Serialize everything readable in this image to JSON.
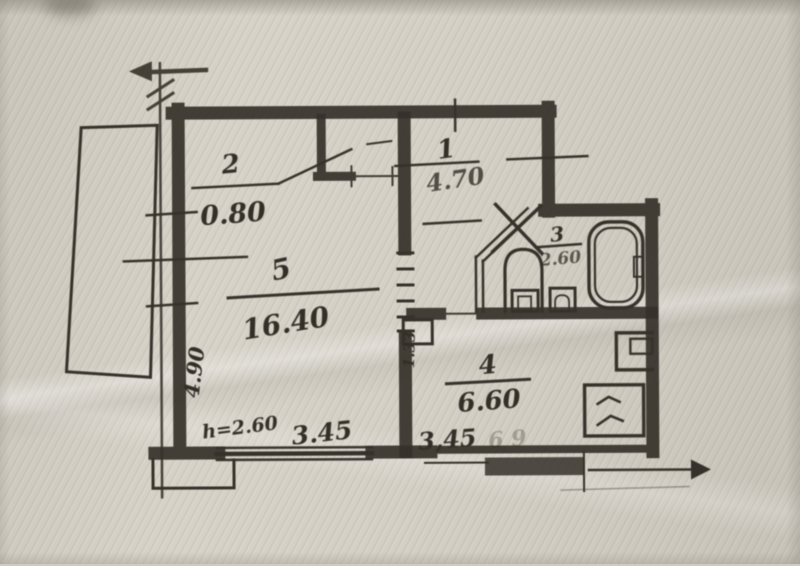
{
  "document": {
    "kind": "scanned apartment floor plan (BTI drawing)",
    "paper_color": "#d3cfc5",
    "ink_color": "#36312a",
    "rooms": [
      {
        "number": "1",
        "area": "4.70"
      },
      {
        "number": "2",
        "area": "0.80"
      },
      {
        "number": "3",
        "area": "2.60"
      },
      {
        "number": "4",
        "area": "6.60"
      },
      {
        "number": "5",
        "area": "16.40"
      }
    ],
    "dimensions": {
      "left_wall_length": "4.90",
      "ceiling_height": "h=2.60",
      "room5_width": "3.45",
      "kitchen_width": "3,45",
      "passage_width": "1.33",
      "faint_marks": "6 9"
    },
    "fixture_icons": [
      "bathtub-icon",
      "toilet-icon",
      "sink-icon",
      "stove-icon",
      "vent-shaft-icon",
      "duct-icon",
      "section-arrow-icon"
    ]
  }
}
